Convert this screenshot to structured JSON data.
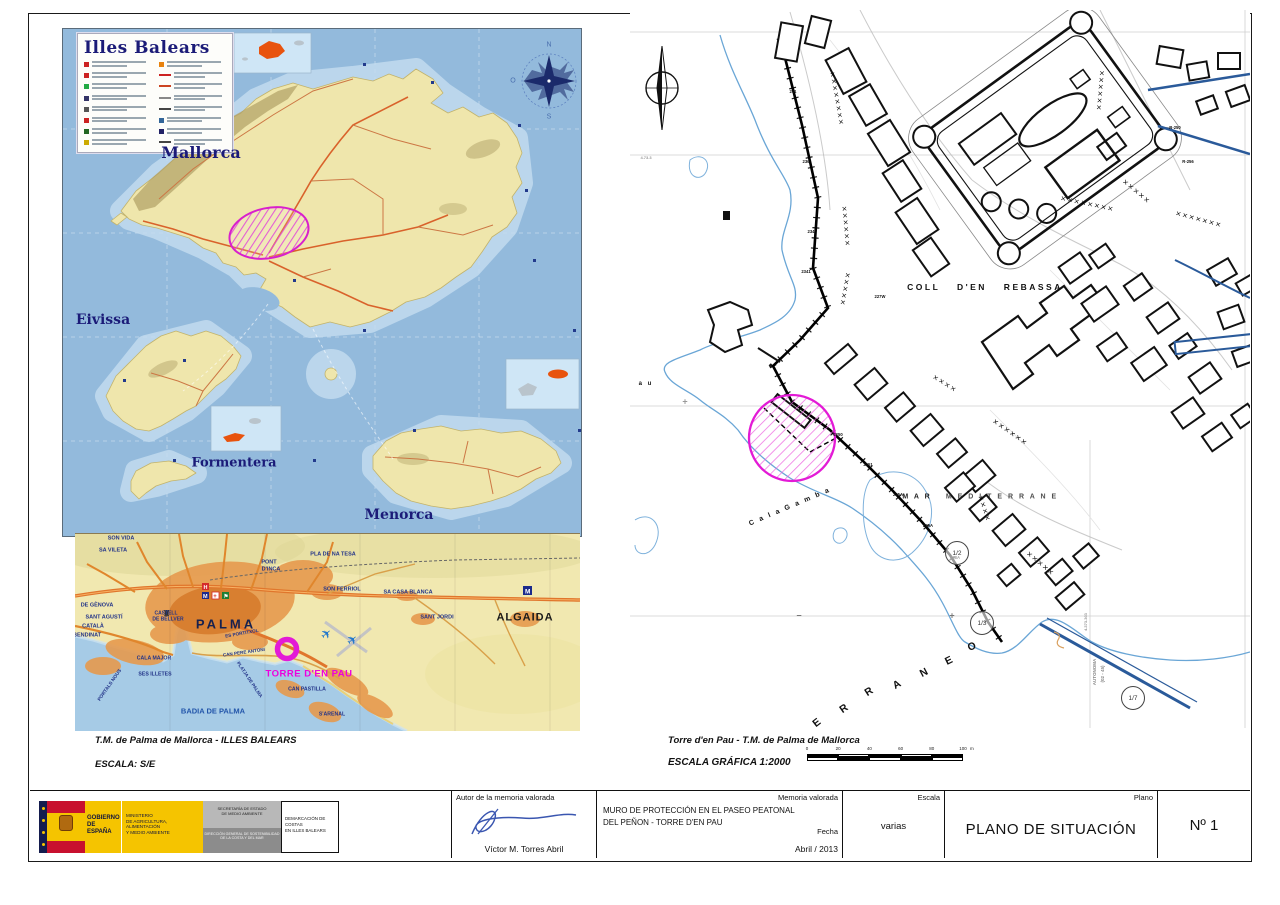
{
  "islands_map": {
    "legend_title": "Illes Balears",
    "compass_points": [
      "N",
      "E",
      "S",
      "O"
    ],
    "labels": [
      {
        "t": "Mallorca",
        "x": 138,
        "y": 124,
        "s": 16,
        "f": "serif",
        "c": "#1b1b78"
      },
      {
        "t": "Eivissa",
        "x": 40,
        "y": 291,
        "s": 14,
        "f": "serif",
        "c": "#1b1b78"
      },
      {
        "t": "Formentera",
        "x": 171,
        "y": 434,
        "s": 13,
        "f": "serif",
        "c": "#1b1b78"
      },
      {
        "t": "Menorca",
        "x": 336,
        "y": 486,
        "s": 14,
        "f": "serif",
        "c": "#1b1b78"
      }
    ]
  },
  "palma_inset": {
    "labels": [
      {
        "t": "SON VIDA",
        "x": 46,
        "y": 5,
        "s": 5.5
      },
      {
        "t": "SA VILETA",
        "x": 38,
        "y": 17,
        "s": 5.5
      },
      {
        "t": "PONT",
        "x": 194,
        "y": 29,
        "s": 5.5
      },
      {
        "t": "D'INCA",
        "x": 196,
        "y": 36,
        "s": 5.5
      },
      {
        "t": "PLA DE NA TESA",
        "x": 258,
        "y": 21,
        "s": 5.5
      },
      {
        "t": "SON FERRIOL",
        "x": 267,
        "y": 56,
        "s": 5.5
      },
      {
        "t": "SA CASA BLANCA",
        "x": 333,
        "y": 59,
        "s": 5.5
      },
      {
        "t": "SANT JORDI",
        "x": 362,
        "y": 84,
        "s": 5.5
      },
      {
        "t": "ALGAIDA",
        "x": 450,
        "y": 84,
        "s": 11,
        "c": "#1a1a1a",
        "ls": 1
      },
      {
        "t": "DE GÈNOVA",
        "x": 22,
        "y": 72,
        "s": 5.5
      },
      {
        "t": "SANT AGUSTÍ",
        "x": 29,
        "y": 84,
        "s": 5.5
      },
      {
        "t": "CATALÀ",
        "x": 18,
        "y": 93,
        "s": 5.5
      },
      {
        "t": "BENDINAT",
        "x": 12,
        "y": 102,
        "s": 5.5
      },
      {
        "t": "CASTELL",
        "x": 91,
        "y": 80,
        "s": 5
      },
      {
        "t": "DE BELLVER",
        "x": 93,
        "y": 86,
        "s": 5
      },
      {
        "t": "PALMA",
        "x": 151,
        "y": 90,
        "s": 13,
        "ls": 3,
        "c": "#16214f"
      },
      {
        "t": "ES PORTITXOL",
        "x": 167,
        "y": 100,
        "s": 4.6,
        "r": -10
      },
      {
        "t": "CAN PERE ANTONI",
        "x": 169,
        "y": 119,
        "s": 4.6,
        "r": -8
      },
      {
        "t": "CALA MAJOR",
        "x": 79,
        "y": 125,
        "s": 5.2
      },
      {
        "t": "SES ILLETES",
        "x": 80,
        "y": 141,
        "s": 5.2
      },
      {
        "t": "PORTALS NOUS",
        "x": 36,
        "y": 152,
        "s": 4.8,
        "r": -55
      },
      {
        "t": "BADIA DE PALMA",
        "x": 138,
        "y": 177,
        "s": 7.5,
        "c": "#2255aa"
      },
      {
        "t": "PLATJA DE PALMA",
        "x": 174,
        "y": 146,
        "s": 4.6,
        "r": 56
      },
      {
        "t": "CAN PASTILLA",
        "x": 232,
        "y": 156,
        "s": 5.2
      },
      {
        "t": "S'ARENAL",
        "x": 257,
        "y": 181,
        "s": 5.2
      },
      {
        "t": "TORRE D'EN PAU",
        "x": 234,
        "y": 140,
        "s": 9.5,
        "c": "#ee00dd",
        "ls": 0.5
      }
    ]
  },
  "site_plan": {
    "labels": [
      {
        "t": "COLL   D'EN   REBASSA",
        "x": 355,
        "y": 277,
        "s": 8.5,
        "ls": 2.5,
        "ws": 12,
        "c": "#111"
      },
      {
        "t": "M A R",
        "x": 287,
        "y": 487,
        "s": 7,
        "c": "#222",
        "ls": 2
      },
      {
        "t": "M E D I T E R R A N E",
        "x": 372,
        "y": 487,
        "s": 7,
        "c": "#222",
        "ls": 2,
        "o": 0.8
      },
      {
        "t": "C a l a     G a m b a",
        "x": 160,
        "y": 497,
        "s": 7,
        "r": -23,
        "ls": 2,
        "c": "#111"
      },
      {
        "t": "a   u",
        "x": 16,
        "y": 374,
        "s": 6,
        "ls": 2,
        "c": "#111"
      }
    ],
    "raneo_letters": [
      {
        "t": "E",
        "x": 187,
        "y": 713,
        "r": -38
      },
      {
        "t": "R",
        "x": 214,
        "y": 699,
        "r": -35
      },
      {
        "t": "R",
        "x": 239,
        "y": 682,
        "r": -33
      },
      {
        "t": "A",
        "x": 267,
        "y": 675,
        "r": -30
      },
      {
        "t": "N",
        "x": 294,
        "y": 663,
        "r": -28
      },
      {
        "t": "E",
        "x": 319,
        "y": 651,
        "r": -26
      },
      {
        "t": "O",
        "x": 342,
        "y": 637,
        "r": -24
      }
    ],
    "fractions": [
      {
        "t": "1/2",
        "x": 327,
        "y": 543
      },
      {
        "t": "1/3",
        "x": 352,
        "y": 613
      },
      {
        "t": "1/7",
        "x": 503,
        "y": 688
      }
    ],
    "tags": [
      {
        "t": "241",
        "x": 163,
        "y": 82
      },
      {
        "t": "236",
        "x": 176,
        "y": 152
      },
      {
        "t": "234",
        "x": 181,
        "y": 222
      },
      {
        "t": "2341",
        "x": 176,
        "y": 262
      },
      {
        "t": "2250",
        "x": 208,
        "y": 425
      },
      {
        "t": "2251",
        "x": 238,
        "y": 455
      },
      {
        "t": "225A",
        "x": 268,
        "y": 485
      },
      {
        "t": "226A",
        "x": 298,
        "y": 516
      },
      {
        "t": "227W",
        "x": 250,
        "y": 287
      },
      {
        "t": "228A",
        "x": 325,
        "y": 548
      },
      {
        "t": "R-250",
        "x": 545,
        "y": 118
      },
      {
        "t": "R-256",
        "x": 558,
        "y": 152
      }
    ],
    "coord_labels": [
      {
        "t": "4.73.3",
        "x": 16,
        "y": 148,
        "s": 4,
        "c": "#999"
      },
      {
        "t": "4.373.303",
        "x": 456,
        "y": 612,
        "r": -90,
        "s": 4,
        "c": "#999"
      },
      {
        "t": "AUTONOMA",
        "x": 465,
        "y": 662,
        "r": -90,
        "s": 4.5,
        "c": "#888"
      },
      {
        "t": "(02 - 45)",
        "x": 473,
        "y": 664,
        "r": -90,
        "s": 4.5,
        "c": "#888"
      }
    ],
    "marks": [
      {
        "t": "−",
        "x": 169,
        "y": 606,
        "s": 9,
        "c": "#777"
      },
      {
        "t": "+",
        "x": 322,
        "y": 606,
        "s": 9,
        "c": "#777"
      },
      {
        "t": "+",
        "x": 55,
        "y": 392,
        "s": 9,
        "c": "#999"
      }
    ]
  },
  "captions": {
    "left1": "T.M. de Palma de Mallorca - ILLES BALEARS",
    "left2": "ESCALA: S/E",
    "right1": "Torre d'en Pau - T.M. de Palma de Mallorca",
    "right2": "ESCALA GRÁFICA   1:2000"
  },
  "scalebar": {
    "ticks": [
      "0",
      "20",
      "40",
      "60",
      "80",
      "100"
    ],
    "unit": "m"
  },
  "title_block": {
    "logo": {
      "gobierno_l1": "GOBIERNO",
      "gobierno_l2": "DE ESPAÑA",
      "ministerio_lines": [
        "MINISTERIO",
        "DE AGRICULTURA, ALIMENTACIÓN",
        "Y MEDIO AMBIENTE"
      ],
      "secretaria_lines": [
        "SECRETARÍA DE ESTADO",
        "DE MEDIO AMBIENTE"
      ],
      "direccion_lines": [
        "DIRECCIÓN GENERAL DE SOSTENIBILIDAD",
        "DE LA COSTA Y DEL MAR"
      ],
      "demarcacion_lines": [
        "DEMARCACIÓN DE COSTAS",
        "EN ILLES BALEARS"
      ]
    },
    "autor_label": "Autor de la memoria valorada",
    "autor_name": "Víctor M. Torres Abril",
    "memoria_label": "Memoria valorada",
    "memoria_title_line1": "MURO DE PROTECCIÓN EN EL PASEO PEATONAL",
    "memoria_title_line2": "DEL PEÑON - TORRE D'EN PAU",
    "fecha_label": "Fecha",
    "fecha_value": "Abril / 2013",
    "escala_label": "Escala",
    "escala_value": "varias",
    "plano_label": "Plano",
    "plano_value": "PLANO DE SITUACIÓN",
    "numero": "Nº 1"
  },
  "colors": {
    "site_magenta": "#e31ad6",
    "sea": "#93badc",
    "land": "#efe6ac",
    "road_orange": "#d9622b",
    "navy_label": "#1b1b78",
    "coast_blue": "#6aa6d6"
  }
}
